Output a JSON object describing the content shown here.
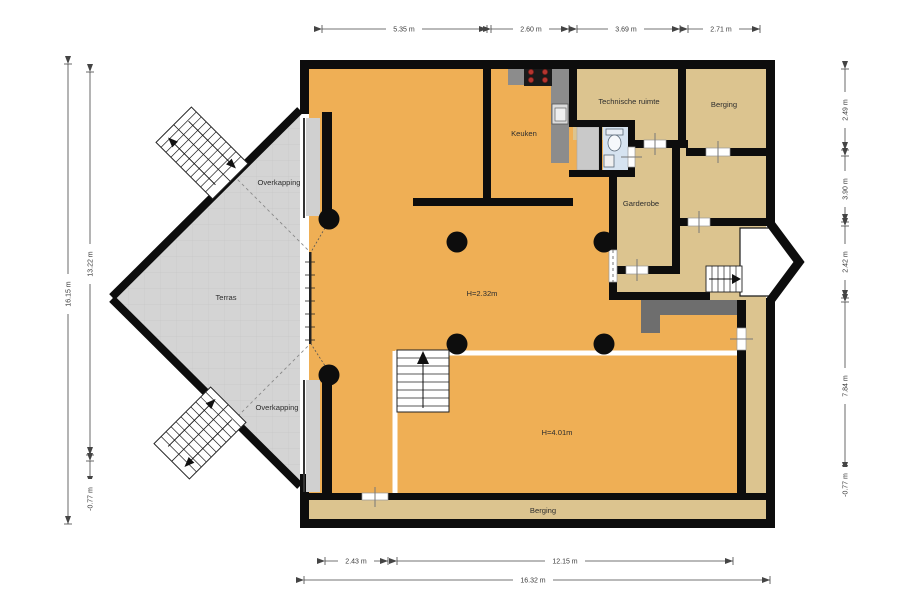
{
  "plan": {
    "rooms": {
      "keuken": "Keuken",
      "technische_ruimte": "Technische ruimte",
      "berging_top": "Berging",
      "garderobe": "Garderobe",
      "terras": "Terras",
      "overkapping_top": "Overkapping",
      "overkapping_bottom": "Overkapping",
      "berging_bottom": "Berging",
      "height_living": "H=2.32m",
      "height_hall": "H=4.01m"
    },
    "dims": {
      "top": [
        "5.35 m",
        "2.60 m",
        "3.69 m",
        "2.71 m"
      ],
      "left": {
        "total": "16.15 m",
        "upper": "13.22 m",
        "lower": "-0.77 m"
      },
      "right": [
        "2.49 m",
        "3.90 m",
        "2.42 m",
        "7.84 m",
        "-0.77 m"
      ],
      "bottom": {
        "seg1": "2.43 m",
        "seg2": "12.15 m",
        "total": "16.32 m"
      }
    },
    "colors": {
      "floor_main": "#efaf55",
      "floor_rooms": "#dcc48f",
      "terrace": "#d4d4d4",
      "walls": "#0d0d0d",
      "counter": "#8c8c8c",
      "cabinet_dark": "#6e6e6e",
      "closet": "#c9c9c9",
      "bathroom": "#d6e3f0",
      "burner_red": "#b5352f"
    }
  }
}
